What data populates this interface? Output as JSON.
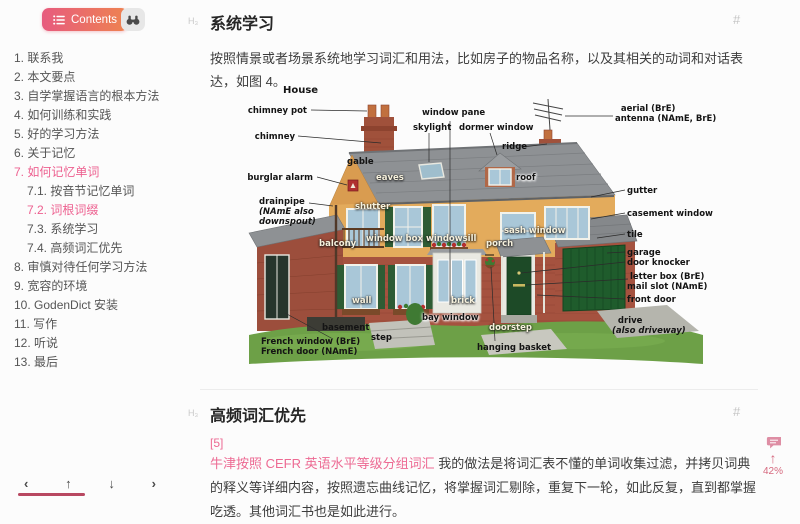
{
  "sidebar": {
    "contents_label": "Contents",
    "toc": [
      {
        "label": "1. 联系我",
        "indent": 0,
        "active": false
      },
      {
        "label": "2. 本文要点",
        "indent": 0,
        "active": false
      },
      {
        "label": "3. 自学掌握语言的根本方法",
        "indent": 0,
        "active": false
      },
      {
        "label": "4. 如何训练和实践",
        "indent": 0,
        "active": false
      },
      {
        "label": "5. 好的学习方法",
        "indent": 0,
        "active": false
      },
      {
        "label": "6. 关于记忆",
        "indent": 0,
        "active": false
      },
      {
        "label": "7. 如何记忆单词",
        "indent": 0,
        "active": true
      },
      {
        "label": "7.1. 按音节记忆单词",
        "indent": 1,
        "active": false
      },
      {
        "label": "7.2. 词根词缀",
        "indent": 1,
        "active": true
      },
      {
        "label": "7.3. 系统学习",
        "indent": 1,
        "active": false
      },
      {
        "label": "7.4. 高频词汇优先",
        "indent": 1,
        "active": false
      },
      {
        "label": "8. 审慎对待任何学习方法",
        "indent": 0,
        "active": false
      },
      {
        "label": "9. 宽容的环境",
        "indent": 0,
        "active": false
      },
      {
        "label": "10. GodenDict 安装",
        "indent": 0,
        "active": false
      },
      {
        "label": "11. 写作",
        "indent": 0,
        "active": false
      },
      {
        "label": "12. 听说",
        "indent": 0,
        "active": false
      },
      {
        "label": "13. 最后",
        "indent": 0,
        "active": false
      }
    ],
    "nav": {
      "prev": "‹",
      "up": "↑",
      "down": "↓",
      "next": "›"
    }
  },
  "main": {
    "section1": {
      "hmark": "H₃",
      "heading": "系统学习",
      "anchor": "#",
      "paragraph": "按照情景或者场景系统地学习词汇和用法，比如房子的物品名称，以及其相关的动词和对话表达，如图 4。"
    },
    "figure": {
      "title": "House",
      "labels": [
        {
          "lines": [
            "chimney pot"
          ],
          "right": 438,
          "top": 23,
          "style": "dark"
        },
        {
          "lines": [
            "chimney"
          ],
          "right": 450,
          "top": 49,
          "style": "dark"
        },
        {
          "lines": [
            "burglar alarm"
          ],
          "right": 432,
          "top": 90,
          "style": "dark"
        },
        {
          "lines": [
            "drainpipe",
            "(NAmE also",
            "downspout)"
          ],
          "left": 14,
          "top": 114,
          "style": "dark",
          "it": [
            1,
            2
          ]
        },
        {
          "lines": [
            "French window (BrE)",
            "French door (NAmE)"
          ],
          "left": 16,
          "top": 254,
          "style": "dark"
        },
        {
          "lines": [
            "window pane"
          ],
          "left": 177,
          "top": 25,
          "style": "dark"
        },
        {
          "lines": [
            "skylight"
          ],
          "left": 168,
          "top": 40,
          "style": "dark"
        },
        {
          "lines": [
            "dormer window"
          ],
          "left": 214,
          "top": 40,
          "style": "dark"
        },
        {
          "lines": [
            "ridge"
          ],
          "left": 257,
          "top": 59,
          "style": "dark"
        },
        {
          "lines": [
            "  aerial (BrE)",
            "antenna (NAmE, BrE)"
          ],
          "left": 370,
          "top": 21,
          "style": "dark"
        },
        {
          "lines": [
            "gutter"
          ],
          "left": 382,
          "top": 103,
          "style": "dark"
        },
        {
          "lines": [
            "casement window"
          ],
          "left": 382,
          "top": 126,
          "style": "dark"
        },
        {
          "lines": [
            "tile"
          ],
          "left": 382,
          "top": 147,
          "style": "dark"
        },
        {
          "lines": [
            "garage"
          ],
          "left": 382,
          "top": 165,
          "style": "dark"
        },
        {
          "lines": [
            "door knocker"
          ],
          "left": 382,
          "top": 175,
          "style": "dark"
        },
        {
          "lines": [
            "letter box (BrE)"
          ],
          "left": 385,
          "top": 189,
          "style": "dark"
        },
        {
          "lines": [
            "mail slot (NAmE)"
          ],
          "left": 382,
          "top": 199,
          "style": "dark"
        },
        {
          "lines": [
            "front door"
          ],
          "left": 382,
          "top": 212,
          "style": "dark"
        },
        {
          "lines": [
            "  drive",
            "(also driveway)"
          ],
          "left": 367,
          "top": 233,
          "style": "dark",
          "it": [
            1
          ]
        },
        {
          "lines": [
            "hanging basket"
          ],
          "left": 232,
          "top": 260,
          "style": "dark"
        },
        {
          "lines": [
            "gable"
          ],
          "left": 102,
          "top": 74,
          "style": "dark"
        },
        {
          "lines": [
            "eaves"
          ],
          "left": 131,
          "top": 90,
          "style": "light"
        },
        {
          "lines": [
            "roof"
          ],
          "left": 271,
          "top": 90,
          "style": "darkhalo"
        },
        {
          "lines": [
            "shutter"
          ],
          "left": 110,
          "top": 119,
          "style": "light"
        },
        {
          "lines": [
            "balcony"
          ],
          "left": 74,
          "top": 156,
          "style": "light"
        },
        {
          "lines": [
            "window box"
          ],
          "left": 121,
          "top": 151,
          "style": "light"
        },
        {
          "lines": [
            "windowsill"
          ],
          "left": 181,
          "top": 151,
          "style": "light"
        },
        {
          "lines": [
            "sash window"
          ],
          "left": 259,
          "top": 143,
          "style": "light"
        },
        {
          "lines": [
            "porch"
          ],
          "left": 241,
          "top": 156,
          "style": "light"
        },
        {
          "lines": [
            "wall"
          ],
          "left": 107,
          "top": 213,
          "style": "light"
        },
        {
          "lines": [
            "brick"
          ],
          "left": 206,
          "top": 213,
          "style": "light"
        },
        {
          "lines": [
            "bay window"
          ],
          "left": 177,
          "top": 230,
          "style": "darkhalo"
        },
        {
          "lines": [
            "basement"
          ],
          "left": 77,
          "top": 240,
          "style": "dark"
        },
        {
          "lines": [
            "step"
          ],
          "left": 126,
          "top": 250,
          "style": "dark"
        },
        {
          "lines": [
            "doorstep"
          ],
          "left": 244,
          "top": 240,
          "style": "light"
        }
      ]
    },
    "section2": {
      "hmark": "H₃",
      "heading": "高频词汇优先",
      "anchor": "#",
      "ref": "[5]",
      "link_text": "牛津按照 CEFR 英语水平等级分组词汇",
      "paragraph": " 我的做法是将词汇表不懂的单词收集过滤，并拷贝词典的释义等详细内容，按照遗忘曲线记忆，将掌握词汇剔除，重复下一轮，如此反复，直到都掌握吃透。其他词汇书也是如此进行。"
    }
  },
  "widget": {
    "progress": "42%"
  },
  "colors": {
    "accent": "#ed5f8f",
    "link": "#ed6a93",
    "progress_bar": "#b84861",
    "btn_gradient_start": "#e75b7e",
    "btn_gradient_end": "#ee8350"
  }
}
